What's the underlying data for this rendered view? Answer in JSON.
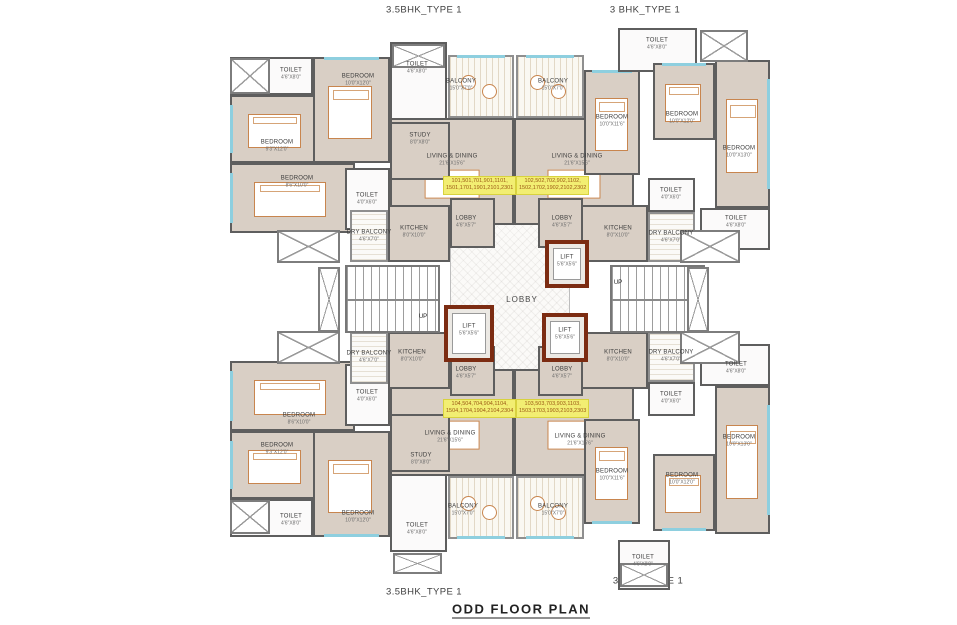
{
  "title": "ODD FLOOR PLAN",
  "type_labels": {
    "top_left": "3.5BHK_TYPE 1",
    "top_right": "3 BHK_TYPE 1",
    "bottom_left": "3.5BHK_TYPE 1",
    "bottom_right": "3 BHK_TYPE 1"
  },
  "colors": {
    "wall": "#5e5e5e",
    "room_fill": "#d9cfc5",
    "lift_border": "#7c2c12",
    "unit_tag_bg": "#f2ee72",
    "unit_tag_text": "#9c5a16",
    "window_glass": "#8ecfdf",
    "furniture_outline": "#c8854e"
  },
  "plan": {
    "rooms": [
      {
        "id": "central-lobby",
        "kind": "core",
        "label": "LOBBY",
        "big": true,
        "x": 450,
        "y": 188,
        "w": 120,
        "h": 240,
        "lx": 522,
        "ly": 300
      },
      {
        "id": "toilet-tl",
        "kind": "wet",
        "label": "TOILET",
        "dim": "4'6\"X8'0\"",
        "x": 230,
        "y": 57,
        "w": 83,
        "h": 38,
        "lx": 291,
        "ly": 74
      },
      {
        "id": "bedroom-tl-left",
        "kind": "room",
        "label": "BEDROOM",
        "dim": "9'3\"X12'0\"",
        "x": 230,
        "y": 95,
        "w": 92,
        "h": 68,
        "lx": 277,
        "ly": 146,
        "bed": true,
        "win": "l"
      },
      {
        "id": "bedroom-tl-lower",
        "kind": "room",
        "label": "BEDROOM",
        "dim": "8'6\"X10'0\"",
        "x": 230,
        "y": 163,
        "w": 125,
        "h": 70,
        "lx": 297,
        "ly": 182,
        "bed": true,
        "win": "l"
      },
      {
        "id": "bedroom-tl-mid",
        "kind": "room",
        "label": "BEDROOM",
        "dim": "10'0\"X12'0\"",
        "x": 313,
        "y": 57,
        "w": 77,
        "h": 106,
        "lx": 358,
        "ly": 80,
        "bed": true,
        "win": "t"
      },
      {
        "id": "toilet-tl-top",
        "kind": "wet",
        "label": "TOILET",
        "dim": "4'6\"X8'0\"",
        "x": 390,
        "y": 42,
        "w": 57,
        "h": 80,
        "lx": 417,
        "ly": 68
      },
      {
        "id": "living-dining-tl",
        "kind": "room",
        "label": "LIVING & DINING",
        "dim": "21'6\"X15'6\"",
        "x": 390,
        "y": 118,
        "w": 124,
        "h": 107,
        "lx": 452,
        "ly": 160,
        "dining": true
      },
      {
        "id": "study-tl",
        "kind": "study",
        "label": "STUDY",
        "dim": "8'0\"X8'0\"",
        "x": 390,
        "y": 122,
        "w": 60,
        "h": 58,
        "lx": 420,
        "ly": 139
      },
      {
        "id": "balcony-tl",
        "kind": "balcony",
        "label": "BALCONY",
        "dim": "15'0\"X7'0\"",
        "x": 448,
        "y": 55,
        "w": 66,
        "h": 63,
        "lx": 461,
        "ly": 85,
        "win": "t"
      },
      {
        "id": "toilet-tl-mid",
        "kind": "wet",
        "label": "TOILET",
        "dim": "4'0\"X6'0\"",
        "x": 345,
        "y": 168,
        "w": 45,
        "h": 62,
        "lx": 367,
        "ly": 199
      },
      {
        "id": "dry-balcony-tl",
        "kind": "dry",
        "label": "DRY BALCONY",
        "dim": "4'6\"X7'0\"",
        "x": 350,
        "y": 210,
        "w": 38,
        "h": 52,
        "lx": 369,
        "ly": 236
      },
      {
        "id": "kitchen-tl",
        "kind": "kitchen",
        "label": "KITCHEN",
        "dim": "8'0\"X10'0\"",
        "x": 388,
        "y": 205,
        "w": 62,
        "h": 57,
        "lx": 414,
        "ly": 232
      },
      {
        "id": "lobby-tl",
        "kind": "lobby",
        "label": "LOBBY",
        "dim": "4'6\"X5'7\"",
        "x": 450,
        "y": 198,
        "w": 45,
        "h": 50,
        "lx": 466,
        "ly": 222
      },
      {
        "id": "balcony-tr",
        "kind": "balcony",
        "label": "BALCONY",
        "dim": "15'0\"X7'0\"",
        "x": 516,
        "y": 55,
        "w": 68,
        "h": 63,
        "lx": 553,
        "ly": 85,
        "win": "t"
      },
      {
        "id": "living-dining-tr",
        "kind": "room",
        "label": "LIVING & DINING",
        "dim": "21'6\"X15'6\"",
        "x": 514,
        "y": 118,
        "w": 120,
        "h": 107,
        "lx": 577,
        "ly": 160,
        "dining": true
      },
      {
        "id": "bedroom-tr-left",
        "kind": "room",
        "label": "BEDROOM",
        "dim": "10'0\"X11'6\"",
        "x": 584,
        "y": 70,
        "w": 56,
        "h": 105,
        "lx": 612,
        "ly": 121,
        "bed": true,
        "win": "t"
      },
      {
        "id": "toilet-tr-top",
        "kind": "wet",
        "label": "TOILET",
        "dim": "4'6\"X8'0\"",
        "x": 618,
        "y": 28,
        "w": 79,
        "h": 44,
        "lx": 657,
        "ly": 44
      },
      {
        "id": "bedroom-tr-mid",
        "kind": "room",
        "label": "BEDROOM",
        "dim": "10'0\"X12'0\"",
        "x": 653,
        "y": 63,
        "w": 62,
        "h": 77,
        "lx": 682,
        "ly": 118,
        "bed": true,
        "win": "t"
      },
      {
        "id": "bedroom-tr-right",
        "kind": "room",
        "label": "BEDROOM",
        "dim": "10'0\"X13'0\"",
        "x": 715,
        "y": 60,
        "w": 55,
        "h": 148,
        "lx": 739,
        "ly": 152,
        "bed": true,
        "win": "r"
      },
      {
        "id": "toilet-tr-mid",
        "kind": "wet",
        "label": "TOILET",
        "dim": "4'0\"X6'0\"",
        "x": 648,
        "y": 178,
        "w": 47,
        "h": 34,
        "lx": 671,
        "ly": 194
      },
      {
        "id": "dry-balcony-tr",
        "kind": "dry",
        "label": "DRY BALCONY",
        "dim": "4'6\"X7'0\"",
        "x": 648,
        "y": 212,
        "w": 47,
        "h": 50,
        "lx": 671,
        "ly": 237
      },
      {
        "id": "kitchen-tr",
        "kind": "kitchen",
        "label": "KITCHEN",
        "dim": "8'0\"X10'0\"",
        "x": 580,
        "y": 205,
        "w": 68,
        "h": 57,
        "lx": 618,
        "ly": 232
      },
      {
        "id": "lobby-tr",
        "kind": "lobby",
        "label": "LOBBY",
        "dim": "4'6\"X5'7\"",
        "x": 538,
        "y": 198,
        "w": 45,
        "h": 50,
        "lx": 562,
        "ly": 222
      },
      {
        "id": "toilet-tr-right",
        "kind": "wet",
        "label": "TOILET",
        "dim": "4'6\"X8'0\"",
        "x": 700,
        "y": 208,
        "w": 70,
        "h": 42,
        "lx": 736,
        "ly": 222
      },
      {
        "id": "lift-1",
        "kind": "lift",
        "label": "LIFT",
        "dim": "5'6\"X5'6\"",
        "x": 545,
        "y": 240,
        "w": 44,
        "h": 48,
        "lx": 567,
        "ly": 261
      },
      {
        "id": "lift-2",
        "kind": "lift",
        "label": "LIFT",
        "dim": "5'6\"X5'6\"",
        "x": 444,
        "y": 305,
        "w": 50,
        "h": 57,
        "lx": 469,
        "ly": 330
      },
      {
        "id": "lift-3",
        "kind": "lift",
        "label": "LIFT",
        "dim": "5'6\"X5'6\"",
        "x": 542,
        "y": 313,
        "w": 46,
        "h": 49,
        "lx": 565,
        "ly": 334
      },
      {
        "id": "staircase-left",
        "kind": "stair",
        "x": 345,
        "y": 265,
        "w": 95,
        "h": 68
      },
      {
        "id": "staircase-right",
        "kind": "stair",
        "x": 610,
        "y": 265,
        "w": 95,
        "h": 68
      },
      {
        "id": "duct-left-1",
        "kind": "void",
        "x": 277,
        "y": 230,
        "w": 63,
        "h": 33
      },
      {
        "id": "duct-left-2",
        "kind": "void",
        "x": 318,
        "y": 267,
        "w": 22,
        "h": 65
      },
      {
        "id": "duct-left-3",
        "kind": "void",
        "x": 277,
        "y": 331,
        "w": 63,
        "h": 33
      },
      {
        "id": "duct-right-1",
        "kind": "void",
        "x": 680,
        "y": 230,
        "w": 60,
        "h": 33
      },
      {
        "id": "duct-right-2",
        "kind": "void",
        "x": 687,
        "y": 267,
        "w": 22,
        "h": 65
      },
      {
        "id": "duct-right-3",
        "kind": "void",
        "x": 680,
        "y": 331,
        "w": 60,
        "h": 33
      },
      {
        "id": "duct-tr-top",
        "kind": "void",
        "x": 700,
        "y": 30,
        "w": 48,
        "h": 32
      },
      {
        "id": "shower-tl",
        "kind": "void",
        "x": 230,
        "y": 58,
        "w": 40,
        "h": 36
      },
      {
        "id": "shower-tl-top",
        "kind": "void",
        "x": 392,
        "y": 44,
        "w": 53,
        "h": 24
      },
      {
        "id": "shower-bl",
        "kind": "void",
        "x": 230,
        "y": 500,
        "w": 40,
        "h": 34
      },
      {
        "id": "shower-bl-bot",
        "kind": "void",
        "x": 393,
        "y": 553,
        "w": 49,
        "h": 21
      },
      {
        "id": "shower-br-bot",
        "kind": "void",
        "x": 620,
        "y": 563,
        "w": 48,
        "h": 24
      },
      {
        "id": "toilet-bl",
        "kind": "wet",
        "label": "TOILET",
        "dim": "4'6\"X8'0\"",
        "x": 230,
        "y": 499,
        "w": 83,
        "h": 38,
        "lx": 291,
        "ly": 520
      },
      {
        "id": "bedroom-bl-left",
        "kind": "room",
        "label": "BEDROOM",
        "dim": "9'3\"X12'0\"",
        "x": 230,
        "y": 431,
        "w": 92,
        "h": 68,
        "lx": 277,
        "ly": 449,
        "bed": true,
        "win": "l"
      },
      {
        "id": "bedroom-bl-upper",
        "kind": "room",
        "label": "BEDROOM",
        "dim": "8'6\"X10'0\"",
        "x": 230,
        "y": 361,
        "w": 125,
        "h": 70,
        "lx": 299,
        "ly": 419,
        "bed": true,
        "win": "l"
      },
      {
        "id": "bedroom-bl-mid",
        "kind": "room",
        "label": "BEDROOM",
        "dim": "10'0\"X12'0\"",
        "x": 313,
        "y": 431,
        "w": 77,
        "h": 106,
        "lx": 358,
        "ly": 517,
        "bed": true,
        "win": "b"
      },
      {
        "id": "toilet-bl-bot",
        "kind": "wet",
        "label": "TOILET",
        "dim": "4'6\"X8'0\"",
        "x": 390,
        "y": 472,
        "w": 57,
        "h": 80,
        "lx": 417,
        "ly": 529
      },
      {
        "id": "living-dining-bl",
        "kind": "room",
        "label": "LIVING & DINING",
        "dim": "21'6\"X15'6\"",
        "x": 390,
        "y": 369,
        "w": 124,
        "h": 107,
        "lx": 450,
        "ly": 437,
        "dining": true
      },
      {
        "id": "study-bl",
        "kind": "study",
        "label": "STUDY",
        "dim": "8'0\"X8'0\"",
        "x": 390,
        "y": 414,
        "w": 60,
        "h": 58,
        "lx": 421,
        "ly": 459
      },
      {
        "id": "balcony-bl",
        "kind": "balcony",
        "label": "BALCONY",
        "dim": "15'0\"X7'0\"",
        "x": 448,
        "y": 476,
        "w": 66,
        "h": 63,
        "lx": 463,
        "ly": 510,
        "win": "b"
      },
      {
        "id": "toilet-bl-mid",
        "kind": "wet",
        "label": "TOILET",
        "dim": "4'0\"X6'0\"",
        "x": 345,
        "y": 364,
        "w": 45,
        "h": 62,
        "lx": 367,
        "ly": 396
      },
      {
        "id": "dry-balcony-bl",
        "kind": "dry",
        "label": "DRY BALCONY",
        "dim": "4'6\"X7'0\"",
        "x": 350,
        "y": 332,
        "w": 38,
        "h": 52,
        "lx": 369,
        "ly": 357
      },
      {
        "id": "kitchen-bl",
        "kind": "kitchen",
        "label": "KITCHEN",
        "dim": "8'0\"X10'0\"",
        "x": 388,
        "y": 332,
        "w": 62,
        "h": 57,
        "lx": 412,
        "ly": 356
      },
      {
        "id": "lobby-bl",
        "kind": "lobby",
        "label": "LOBBY",
        "dim": "4'6\"X5'7\"",
        "x": 450,
        "y": 346,
        "w": 45,
        "h": 50,
        "lx": 466,
        "ly": 373
      },
      {
        "id": "balcony-br",
        "kind": "balcony",
        "label": "BALCONY",
        "dim": "15'0\"X7'0\"",
        "x": 516,
        "y": 476,
        "w": 68,
        "h": 63,
        "lx": 553,
        "ly": 510,
        "win": "b"
      },
      {
        "id": "living-dining-br",
        "kind": "room",
        "label": "LIVING & DINING",
        "dim": "21'6\"X15'6\"",
        "x": 514,
        "y": 369,
        "w": 120,
        "h": 107,
        "lx": 580,
        "ly": 440,
        "dining": true
      },
      {
        "id": "bedroom-br-left",
        "kind": "room",
        "label": "BEDROOM",
        "dim": "10'0\"X11'6\"",
        "x": 584,
        "y": 419,
        "w": 56,
        "h": 105,
        "lx": 612,
        "ly": 475,
        "bed": true,
        "win": "b"
      },
      {
        "id": "toilet-br-bot",
        "kind": "wet",
        "label": "TOILET",
        "dim": "4'6\"X8'0\"",
        "x": 618,
        "y": 540,
        "w": 52,
        "h": 50,
        "lx": 643,
        "ly": 561
      },
      {
        "id": "bedroom-br-mid",
        "kind": "room",
        "label": "BEDROOM",
        "dim": "10'0\"X12'0\"",
        "x": 653,
        "y": 454,
        "w": 62,
        "h": 77,
        "lx": 682,
        "ly": 479,
        "bed": true,
        "win": "b"
      },
      {
        "id": "bedroom-br-right",
        "kind": "room",
        "label": "BEDROOM",
        "dim": "10'0\"X13'0\"",
        "x": 715,
        "y": 386,
        "w": 55,
        "h": 148,
        "lx": 739,
        "ly": 441,
        "bed": true,
        "win": "r"
      },
      {
        "id": "toilet-br-mid",
        "kind": "wet",
        "label": "TOILET",
        "dim": "4'0\"X6'0\"",
        "x": 648,
        "y": 382,
        "w": 47,
        "h": 34,
        "lx": 671,
        "ly": 398
      },
      {
        "id": "dry-balcony-br",
        "kind": "dry",
        "label": "DRY BALCONY",
        "dim": "4'6\"X7'0\"",
        "x": 648,
        "y": 332,
        "w": 47,
        "h": 50,
        "lx": 671,
        "ly": 356
      },
      {
        "id": "kitchen-br",
        "kind": "kitchen",
        "label": "KITCHEN",
        "dim": "8'0\"X10'0\"",
        "x": 580,
        "y": 332,
        "w": 68,
        "h": 57,
        "lx": 618,
        "ly": 356
      },
      {
        "id": "lobby-br",
        "kind": "lobby",
        "label": "LOBBY",
        "dim": "4'6\"X5'7\"",
        "x": 538,
        "y": 346,
        "w": 45,
        "h": 50,
        "lx": 562,
        "ly": 373
      },
      {
        "id": "toilet-br-right",
        "kind": "wet",
        "label": "TOILET",
        "dim": "4'6\"X8'0\"",
        "x": 700,
        "y": 344,
        "w": 70,
        "h": 42,
        "lx": 736,
        "ly": 368
      }
    ],
    "unit_tags": [
      {
        "id": "unit-numbers-101",
        "x": 443,
        "y": 176,
        "line1": "101,501,701,901,1101,",
        "line2": "1501,1701,1901,2101,2301"
      },
      {
        "id": "unit-numbers-102",
        "x": 516,
        "y": 176,
        "line1": "102,502,702,902,1102,",
        "line2": "1502,1702,1902,2102,2302"
      },
      {
        "id": "unit-numbers-104",
        "x": 443,
        "y": 399,
        "line1": "104,504,704,904,1104,",
        "line2": "1504,1704,1904,2104,2304"
      },
      {
        "id": "unit-numbers-103",
        "x": 516,
        "y": 399,
        "line1": "103,503,703,903,1103,",
        "line2": "1503,1703,1903,2103,2303"
      }
    ],
    "up_labels": [
      {
        "x": 423,
        "y": 317,
        "text": "UP"
      },
      {
        "x": 618,
        "y": 283,
        "text": "UP"
      }
    ]
  }
}
